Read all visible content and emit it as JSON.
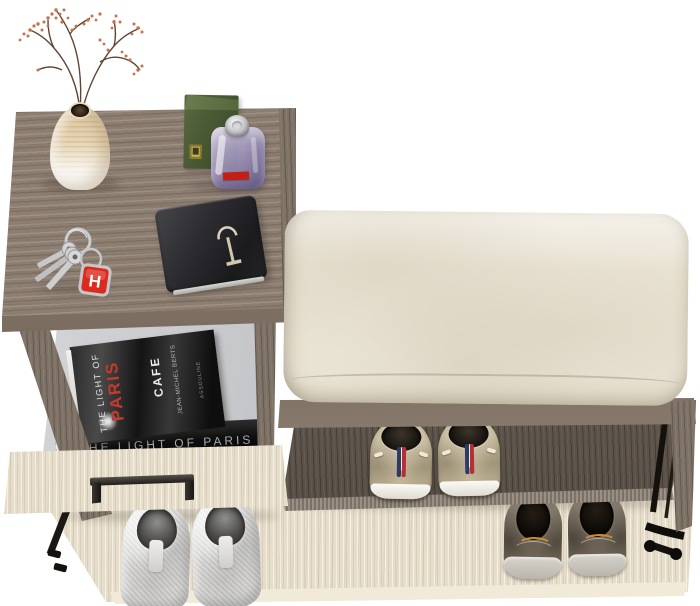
{
  "scene": {
    "type": "product-photo",
    "description": "Hallway shoe-storage bench: cabinet with open book drawer, seat cushion, tilted shoe flap, decor on top",
    "background": "#ffffff"
  },
  "palette": {
    "cabinet_wood": "#8d7e72",
    "dark_wood": "#6a6057",
    "light_ash": "#e6ddca",
    "cushion": "#e9e3d4",
    "drawer_interior": "#c2c4c7",
    "metal_black": "#1b1814",
    "handle_metal": "#2e2b27",
    "keychain_red": "#dc2a1e",
    "perfume_box_green": "#495a34",
    "perfume_bottle_lavender": "#b4a6c9",
    "vase_cream": "#eadbbf",
    "berries_orange": "#c9714a",
    "book_title_red": "#c23b2e",
    "canvas_sneaker_beige": "#c6ba9b",
    "slipon_brown": "#7a6f61",
    "plush_sneaker_grey": "#d9d8d6"
  },
  "objects": {
    "book_top": {
      "title_prefix": "THE LIGHT OF",
      "title_accent": "PARIS",
      "subtitle": "CAFE",
      "author": "JEAN-MICHEL BERTS",
      "publisher": "ASSOULINE"
    },
    "book_bottom": {
      "spine_text": "THE LIGHT OF PARIS"
    },
    "keychain": {
      "letter": "H"
    },
    "item_names": [
      "ceramic vase with dried berry branches",
      "green perfume box",
      "lavender perfume bottle",
      "black wallet with clasp",
      "key bunch with red fob",
      "seat cushion",
      "beige canvas sneakers",
      "brown slip-on shoes",
      "white plush sneakers"
    ]
  }
}
